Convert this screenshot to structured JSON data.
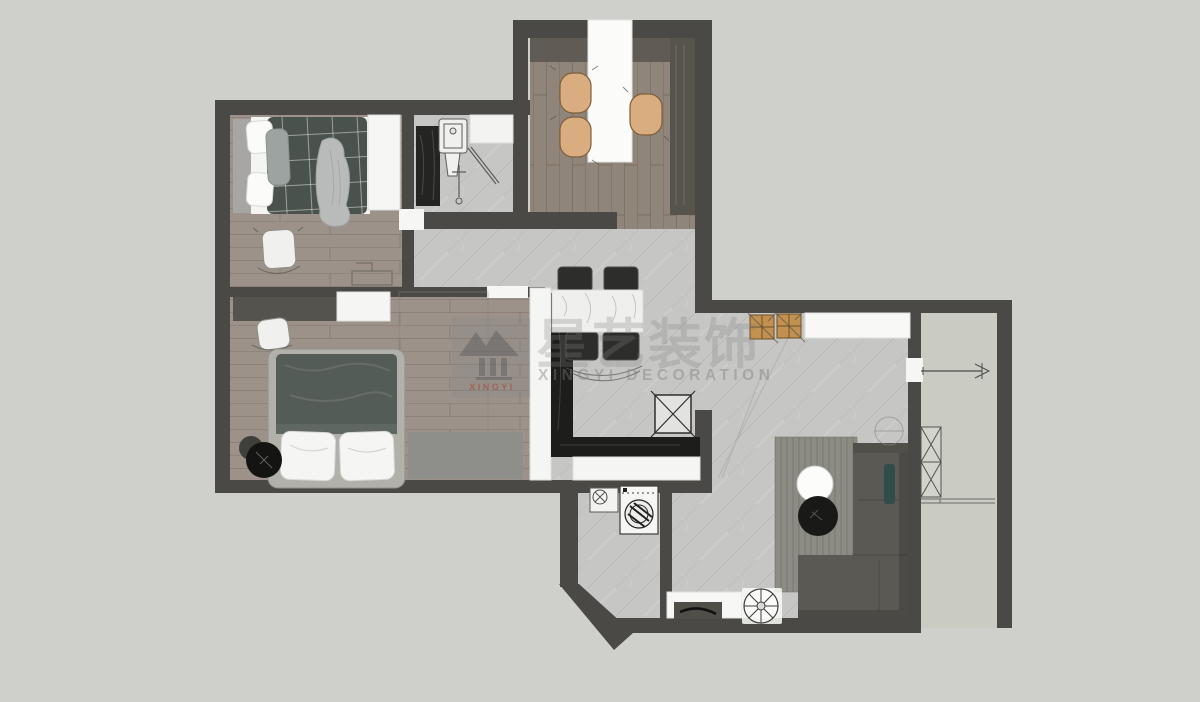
{
  "watermark": {
    "logo_text": "XINGYI",
    "brand_cn": "星艺装饰",
    "brand_en": "XINGYI DECORATION"
  },
  "palette": {
    "background": "#cfcfcb",
    "wall": "#4a4945",
    "wood_bedroom": "#9c9289",
    "wood_dining": "#90857a",
    "tile": "#c6c6c4",
    "balcony_floor": "#caccc4",
    "counter_black": "#1d1d1b",
    "cabinet_white": "#f5f5f3",
    "sofa": "#5b5953",
    "rug": "#8c8c84",
    "duvet_small_bedroom": "#4a524d",
    "duvet_master_bedroom": "#545c58",
    "chair_tan": "#d9ad80",
    "stool_tan": "#c3914f",
    "pillow_white": "#f5f5f3",
    "accent_teal": "#2f4e49"
  }
}
